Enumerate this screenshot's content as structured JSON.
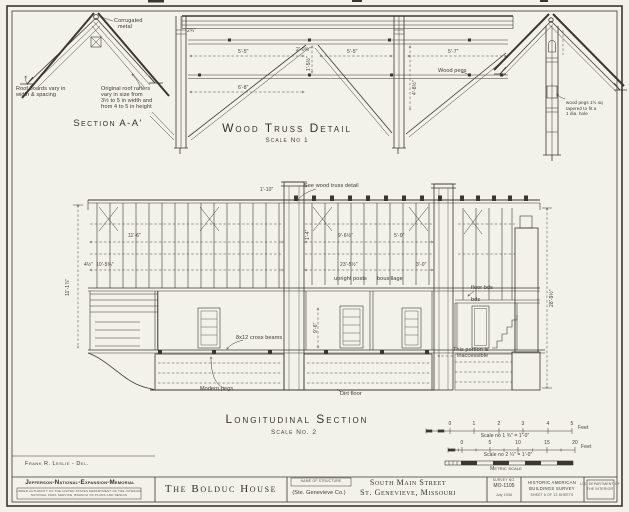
{
  "page": {
    "paper_color": "#f2f1ea",
    "ink_color": "#39372f"
  },
  "sa": {
    "title": "Section A-A'",
    "corr1": "Corrugated",
    "corr2": "metal",
    "boards1": "Roof boards vary in",
    "boards2": "width & spacing",
    "raft1": "Original roof rafters",
    "raft2": "vary in size from",
    "raft3": "3½ to 5 in width and",
    "raft4": "from 4 to 5 in height"
  },
  "truss": {
    "title": "Wood Truss Detail",
    "scale": "Scale No 1",
    "pegs": "Wood pegs",
    "dims": [
      "2¾\"",
      "5'-5\"",
      "2'-0¾\"",
      "1'-5½\"",
      "5'-5\"",
      "5'-7\"",
      "4'-8½\"",
      "6'-8\""
    ]
  },
  "gable": {
    "note1": "wood pegs 1½ sq",
    "note2": "tapered to fit a",
    "note3": "1 dia. hole"
  },
  "ls": {
    "title": "Longitudinal Section",
    "scale": "Scale No. 2",
    "ann": {
      "see_truss": "See wood truss detail",
      "upright_posts": "upright posts",
      "bousillage": "bousillage",
      "cross_beams": "8x12 cross beams",
      "modern_pegs": "Modern pegs",
      "dirt_floor": "Dirt floor",
      "inaccessible_1": "This portion is",
      "inaccessible_2": "inaccessible",
      "floor_bds": "floor bds",
      "bds": "bds"
    },
    "dims": [
      "11'-6\"",
      "4½\"",
      "10'-5¾\"",
      "23'-5½\"",
      "9'-6½\"",
      "5'-0\"",
      "3'-0\"",
      "1'-4\"",
      "28'-9½\"",
      "11'-1⅞\"",
      "9'-6\"",
      "1'-10\""
    ]
  },
  "bars": {
    "cap1": "Scale no 1   ¾\" = 1'-0\"",
    "cap2": "Scale no 2   ¼\" = 1'-0\"",
    "metric": "Metric scale",
    "feet": "Feet",
    "n1": [
      "0",
      "1",
      "2",
      "3",
      "4",
      "5"
    ],
    "n2": [
      "0",
      "5",
      "10",
      "15",
      "20"
    ]
  },
  "credits": {
    "delineator": "Frank R. Leslie - Del."
  },
  "tb": {
    "agency": "Jefferson-National-Expansion-Memorial",
    "sub1": "UNDER AUTHORITY OF THE UNITED STATES DEPARTMENT OF THE INTERIOR",
    "sub2": "NATIONAL PARK SERVICE, BRANCH OF PLANS AND DESIGN",
    "name": "The Bolduc House",
    "name_label": "NAME OF STRUCTURE",
    "county": "(Ste. Genevieve Co.)",
    "addr1": "South Main Street",
    "addr2": "St. Genevieve, Missouri",
    "survey_label": "SURVEY NO.",
    "survey_no": "MO-1105",
    "survey_date": "July 1936",
    "habs1": "HISTORIC AMERICAN",
    "habs2": "BUILDINGS SURVEY",
    "habs3": "SHEET 6 OF 13 SHEETS",
    "corner1": "U.S. DEPARTMENT OF",
    "corner2": "THE INTERIOR"
  }
}
